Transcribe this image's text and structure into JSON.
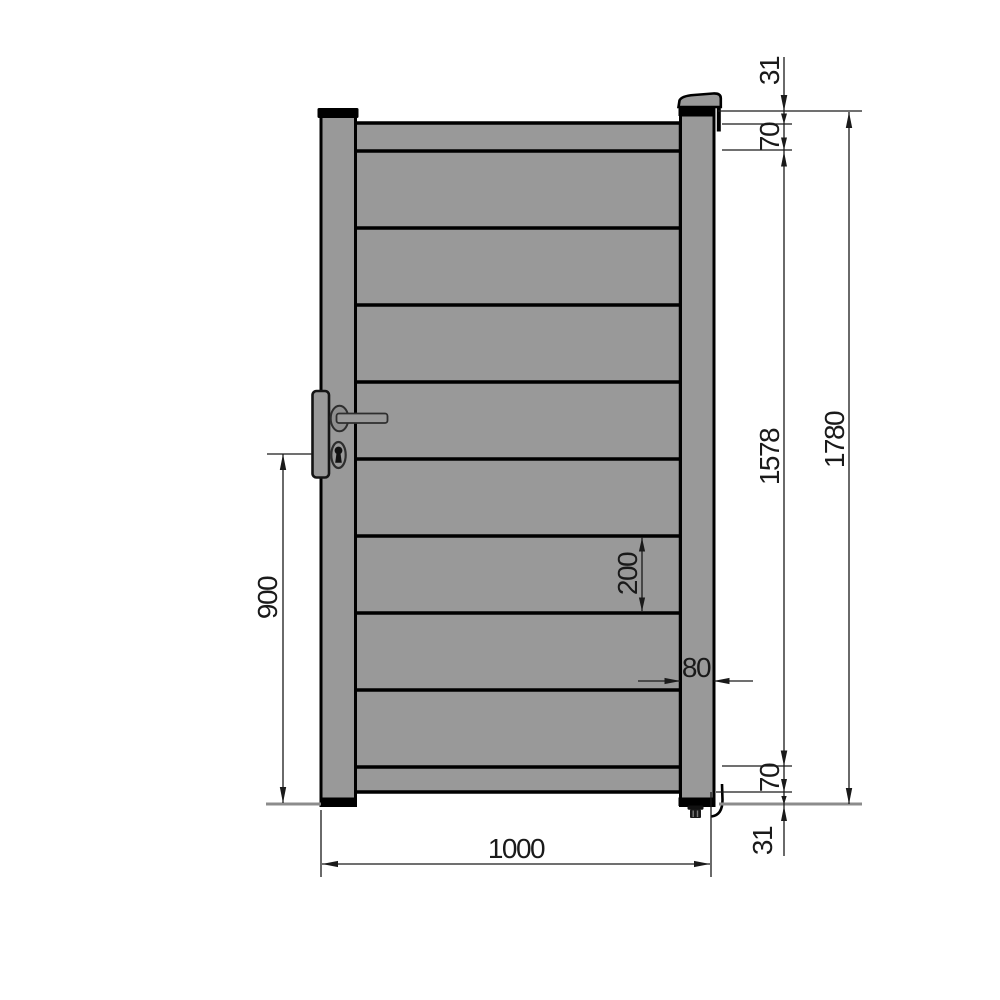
{
  "drawing": {
    "subject": "single-gate-front-elevation-technical-drawing",
    "slat_count": 8,
    "colors": {
      "panel": "#999999",
      "handle_rose": "#8e8e8e",
      "outline": "#000000",
      "dim_line": "#1a1a1a",
      "ground_line": "#8c8c8c",
      "background": "#ffffff"
    },
    "dims": {
      "top_offset": "31",
      "top_rail": "70",
      "infill_height": "1578",
      "total_height": "1780",
      "slat_height": "200",
      "post_width": "80",
      "handle_height": "900",
      "bottom_rail": "70",
      "bottom_offset": "31",
      "total_width": "1000"
    }
  }
}
